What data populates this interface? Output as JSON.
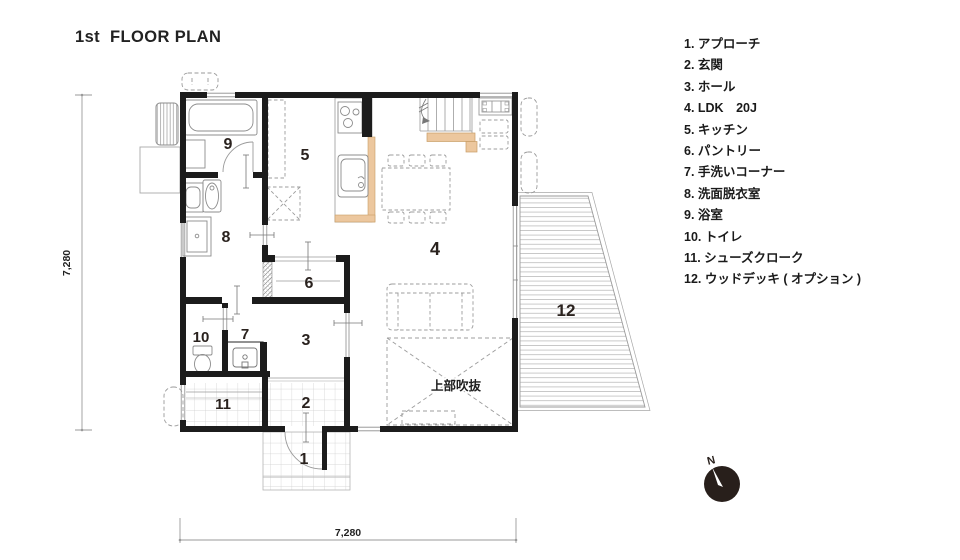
{
  "title": "1st  FLOOR PLAN",
  "legend": {
    "items": [
      "1. アプローチ",
      "2. 玄関",
      "3. ホール",
      "4. LDK　20J",
      "5. キッチン",
      "6. パントリー",
      "7. 手洗いコーナー",
      "8. 洗面脱衣室",
      "9. 浴室",
      "10. トイレ",
      "11. シューズクローク",
      "12. ウッドデッキ ( オプション )"
    ]
  },
  "plan": {
    "rooms": {
      "r1": "1",
      "r2": "2",
      "r3": "3",
      "r4": "4",
      "r5": "5",
      "r6": "6",
      "r7": "7",
      "r8": "8",
      "r9": "9",
      "r10": "10",
      "r11": "11",
      "r12": "12"
    },
    "void_label": "上部吹抜",
    "dimensions": {
      "left": "7,280",
      "bottom": "7,280"
    },
    "compass": {
      "label": "N"
    }
  },
  "colors": {
    "wall": "#1c1c1c",
    "wood_accent": "#ecc79e",
    "fixture_line": "#8c8c8c",
    "tile_grid": "#cdcdcd",
    "deck_board": "#bcbcbc",
    "compass_fill": "#281f1b"
  }
}
